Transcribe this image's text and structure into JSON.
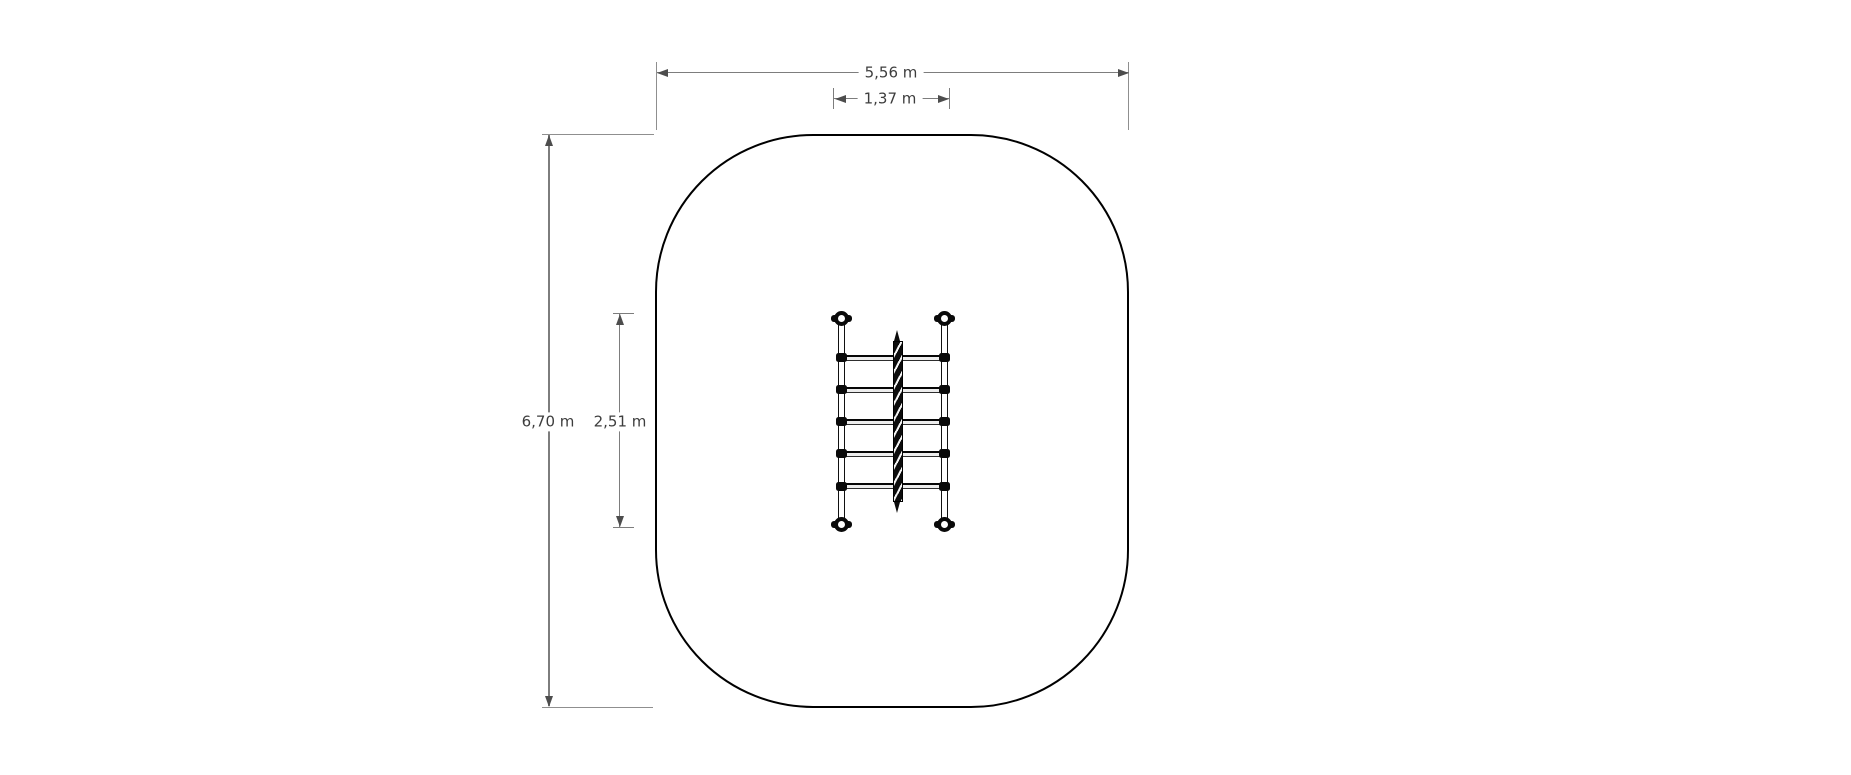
{
  "drawing": {
    "name": "playground-climber-plan-view",
    "unit": "m",
    "dimensions": {
      "area_width": {
        "label": "5,56 m",
        "value": 5.56
      },
      "equipment_width": {
        "label": "1,37 m",
        "value": 1.37
      },
      "area_length": {
        "label": "6,70 m",
        "value": 6.7
      },
      "equipment_length": {
        "label": "2,51 m",
        "value": 2.51
      }
    },
    "equipment": {
      "rungs": 5,
      "corner_posts": 4,
      "center_poles": 1
    },
    "colors": {
      "background": "#ffffff",
      "outline": "#000000",
      "dimension_line": "#7d7d7d",
      "extension_line": "#8f8f8f",
      "arrow": "#4d4d4d",
      "label_text": "#3d3d3d",
      "equipment": "#0a0a0a"
    }
  }
}
